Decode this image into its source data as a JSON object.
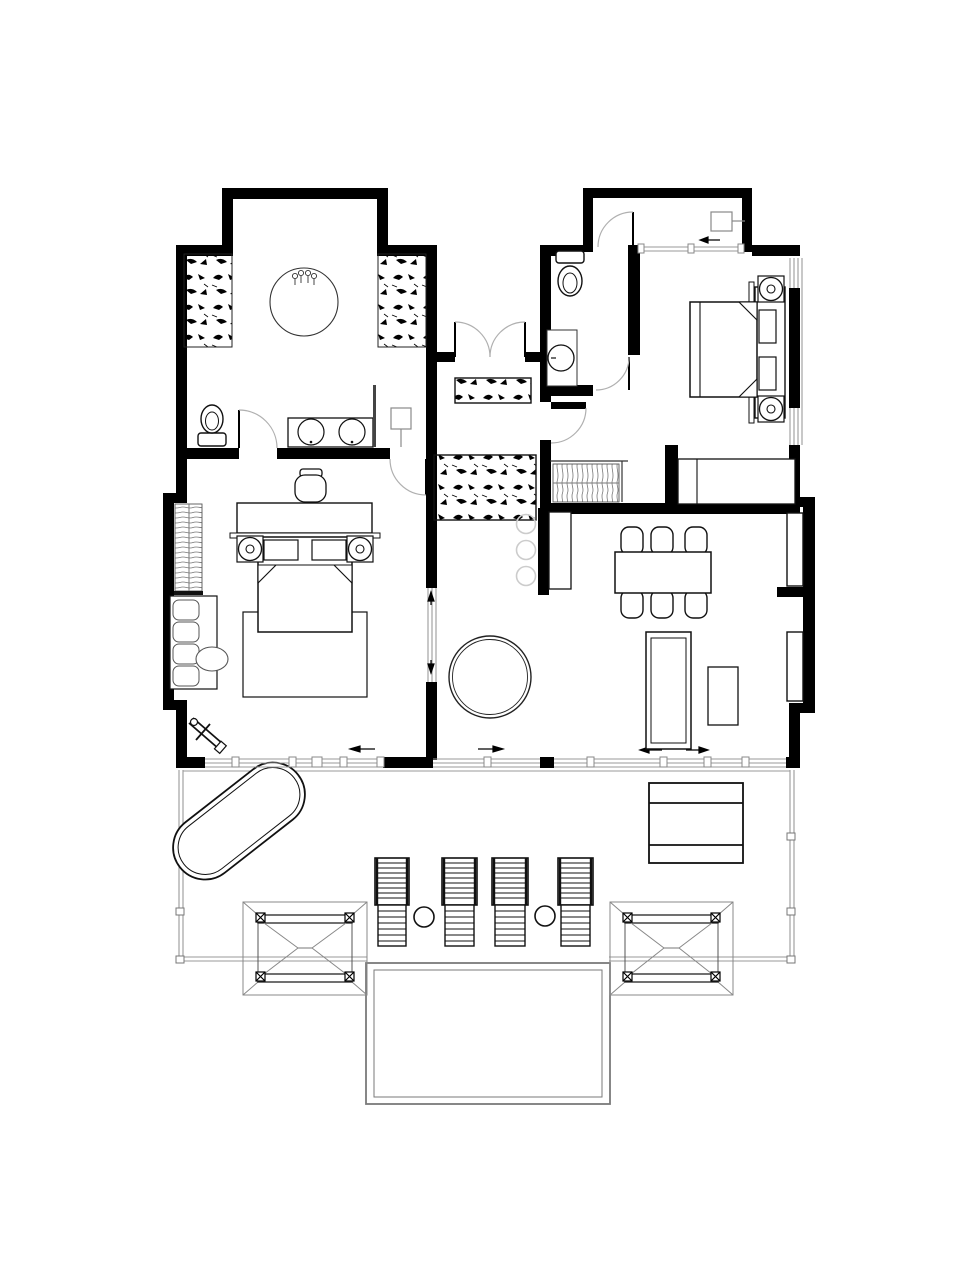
{
  "meta": {
    "title": "Two-bedroom villa floor plan with pool deck",
    "document_type": "architectural-floor-plan",
    "canvas": {
      "width": 975,
      "height": 1280
    },
    "visible_text": "none"
  },
  "colors": {
    "background": "#ffffff",
    "walls": "#000000",
    "furniture_line": "#111111",
    "glazing_line": "#9a9a9a",
    "deck_line": "#999999",
    "pool_line": "#7a7a7a",
    "stepping_stone": "#cccccc",
    "lamp_line": "#8a8a8a"
  },
  "rooms": [
    {
      "id": "master-bathroom",
      "name": "master bathroom",
      "furniture": [
        "round-soaking-tub",
        "double-sink-vanity",
        "toilet",
        "floor-lamp",
        "mirror-partition",
        "planting-bed-left",
        "planting-bed-right",
        "outdoor-alcove"
      ]
    },
    {
      "id": "master-bedroom",
      "name": "master bedroom",
      "furniture": [
        "double-bed",
        "headboard-shelf",
        "two-round-nightstands",
        "two-pillows",
        "accent-chair",
        "rug",
        "wardrobe-hanging",
        "sofa",
        "side-table",
        "luggage-rack",
        "sliding-glass-wall"
      ]
    },
    {
      "id": "entry-breezeway",
      "name": "entry breezeway",
      "furniture": [
        "double-entry-doors",
        "planter-small",
        "planter-large",
        "stepping-stones"
      ]
    },
    {
      "id": "guest-wc",
      "name": "guest wc",
      "furniture": [
        "toilet",
        "washbasin-counter"
      ]
    },
    {
      "id": "entry-vestibule",
      "name": "entry vestibule",
      "furniture": [
        "entry-door",
        "wall-fixture",
        "sliding-door"
      ]
    },
    {
      "id": "guest-bedroom",
      "name": "guest bedroom",
      "furniture": [
        "double-bed",
        "headboard-shelf",
        "two-round-nightstands",
        "two-pillows",
        "closet-hanging",
        "low-counter",
        "window-wall"
      ]
    },
    {
      "id": "living-dining",
      "name": "living / dining",
      "furniture": [
        "dining-table-6-chairs",
        "daybed-bench",
        "side-table",
        "round-coffee-table",
        "console-table",
        "wall-niche-upper",
        "wall-niche-lower",
        "sliding-glass-wall"
      ]
    }
  ],
  "outdoor": {
    "name": "pool deck",
    "items": [
      "outdoor-oval-bathtub",
      "sun-lounger-1",
      "sun-lounger-2",
      "sun-lounger-3",
      "sun-lounger-4",
      "round-side-table-1",
      "round-side-table-2",
      "outdoor-dining-table-benches",
      "pergola-left",
      "pergola-right",
      "swimming-pool",
      "deck-railing"
    ]
  }
}
